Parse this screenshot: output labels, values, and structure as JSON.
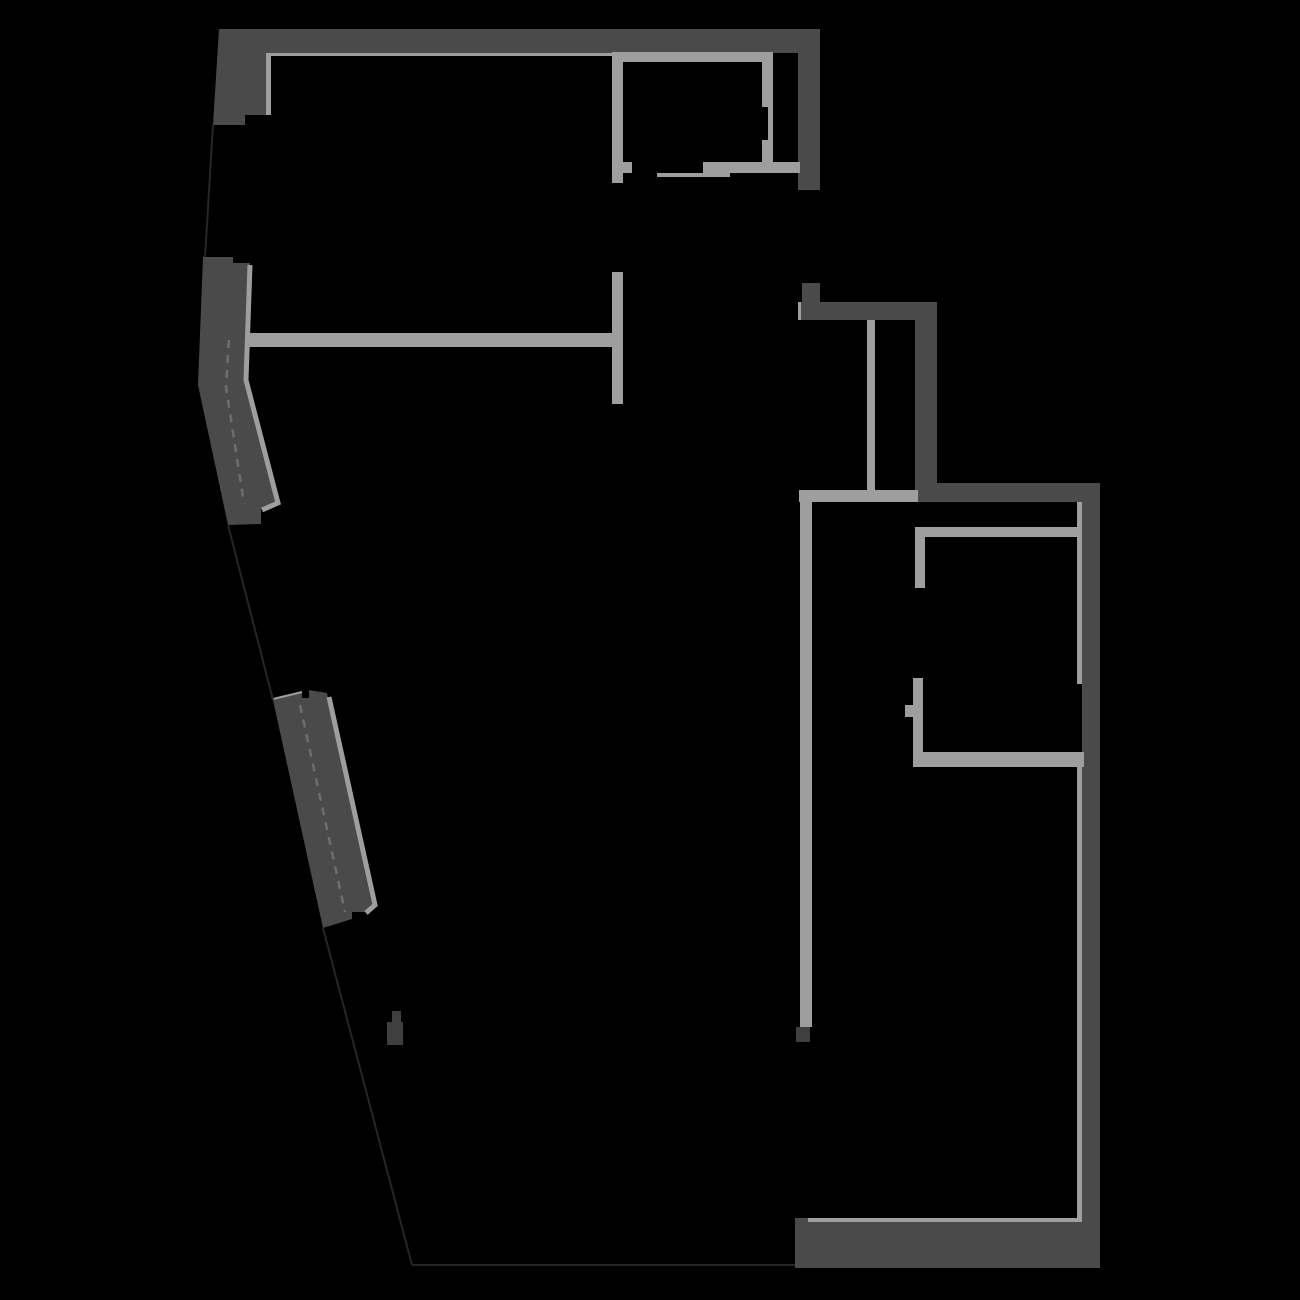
{
  "floorplan": {
    "canvas": {
      "width": 1300,
      "height": 1300,
      "background": "#000000"
    },
    "colors": {
      "bg": "#000000",
      "wall_dark": "#4a4a4a",
      "wall_darker": "#3f3f3f",
      "wall_light": "#9e9e9e",
      "boundary_line": "#262626",
      "glazing_dash": "#6e6e6e"
    },
    "elements": [
      {
        "name": "facade-upper-segment",
        "shape": "polygon",
        "color": "wall_dark",
        "points": "219,29 266,29 266,115 245,115 245,125 213,125"
      },
      {
        "name": "north-outer-wall",
        "shape": "rect",
        "color": "wall_dark",
        "x": 266,
        "y": 29,
        "w": 532,
        "h": 24
      },
      {
        "name": "entry-east-wall",
        "shape": "rect",
        "color": "wall_dark",
        "x": 798,
        "y": 29,
        "w": 22,
        "h": 161
      },
      {
        "name": "facade-middle-segment",
        "shape": "polygon",
        "color": "wall_dark",
        "points": "203,257 233,257 233,263 250,263 246,380 277,505 261,509 261,524 228,525 198,385"
      },
      {
        "name": "facade-lower-segment",
        "shape": "polygon",
        "color": "wall_dark",
        "points": "273,700 302,692 302,698 309,698 309,690 327,693 373,908 365,912 352,912 352,919 323,928"
      },
      {
        "name": "stair-north-wall",
        "shape": "rect",
        "color": "wall_dark",
        "x": 799,
        "y": 302,
        "w": 138,
        "h": 18
      },
      {
        "name": "stair-north-stub",
        "shape": "rect",
        "color": "wall_dark",
        "x": 802,
        "y": 283,
        "w": 18,
        "h": 19
      },
      {
        "name": "stair-east-wall",
        "shape": "rect",
        "color": "wall_dark",
        "x": 915,
        "y": 320,
        "w": 22,
        "h": 163
      },
      {
        "name": "hall-south-wall",
        "shape": "rect",
        "color": "wall_dark",
        "x": 915,
        "y": 483,
        "w": 185,
        "h": 19
      },
      {
        "name": "east-outer-wall",
        "shape": "rect",
        "color": "wall_dark",
        "x": 1082,
        "y": 483,
        "w": 18,
        "h": 785
      },
      {
        "name": "south-outer-wall",
        "shape": "rect",
        "color": "wall_dark",
        "x": 795,
        "y": 1218,
        "w": 305,
        "h": 50
      },
      {
        "name": "kitchen-wall-end-cap",
        "shape": "rect",
        "color": "wall_darker",
        "x": 796,
        "y": 1027,
        "w": 14,
        "h": 15
      },
      {
        "name": "utility-mark",
        "shape": "polygon",
        "color": "wall_darker",
        "points": "392,1011 401,1011 401,1022 403,1022 403,1045 387,1045 387,1022 392,1022"
      },
      {
        "name": "north-wall-inner-face",
        "shape": "rect",
        "color": "wall_light",
        "x": 266,
        "y": 53,
        "w": 346,
        "h": 3
      },
      {
        "name": "corner-inner-face",
        "shape": "rect",
        "color": "wall_light",
        "x": 266,
        "y": 53,
        "w": 5,
        "h": 62
      },
      {
        "name": "closet-top-wall",
        "shape": "rect",
        "color": "wall_light",
        "x": 612,
        "y": 52,
        "w": 161,
        "h": 10
      },
      {
        "name": "closet-left-wall",
        "shape": "rect",
        "color": "wall_light",
        "x": 612,
        "y": 52,
        "w": 11,
        "h": 131
      },
      {
        "name": "closet-left-door-jamb",
        "shape": "rect",
        "color": "wall_light",
        "x": 623,
        "y": 162,
        "w": 9,
        "h": 11
      },
      {
        "name": "closet-right-wall",
        "shape": "rect",
        "color": "wall_light",
        "x": 762,
        "y": 52,
        "w": 11,
        "h": 121
      },
      {
        "name": "closet-right-wall-recess",
        "shape": "rect",
        "color": "bg",
        "x": 762,
        "y": 107,
        "w": 6,
        "h": 33
      },
      {
        "name": "closet-bottom-wall",
        "shape": "rect",
        "color": "wall_light",
        "x": 703,
        "y": 162,
        "w": 97,
        "h": 11
      },
      {
        "name": "closet-door-threshold",
        "shape": "rect",
        "color": "wall_light",
        "x": 657,
        "y": 173,
        "w": 73,
        "h": 4
      },
      {
        "name": "bedroom-divider-wall",
        "shape": "rect",
        "color": "wall_light",
        "x": 247,
        "y": 333,
        "w": 365,
        "h": 14
      },
      {
        "name": "bedroom-divider-return",
        "shape": "rect",
        "color": "wall_light",
        "x": 612,
        "y": 272,
        "w": 11,
        "h": 132
      },
      {
        "name": "facade-middle-inner-edge",
        "shape": "polyline",
        "color": "wall_light",
        "points": "250,265 246,380 278,503 262,510",
        "width": 5
      },
      {
        "name": "facade-lower-inner-edge",
        "shape": "polyline",
        "color": "wall_light",
        "points": "329,697 375,905 366,913",
        "width": 5
      },
      {
        "name": "facade-lower-top-edge",
        "shape": "polyline",
        "color": "wall_light",
        "points": "273,699 302,692",
        "width": 2
      },
      {
        "name": "hall-divider-wall",
        "shape": "rect",
        "color": "wall_light",
        "x": 799,
        "y": 490,
        "w": 119,
        "h": 12
      },
      {
        "name": "stair-rail-wall",
        "shape": "rect",
        "color": "wall_light",
        "x": 867,
        "y": 320,
        "w": 8,
        "h": 170
      },
      {
        "name": "kitchen-wall",
        "shape": "rect",
        "color": "wall_light",
        "x": 800,
        "y": 492,
        "w": 12,
        "h": 535
      },
      {
        "name": "bathroom-top-wall",
        "shape": "rect",
        "color": "wall_light",
        "x": 915,
        "y": 527,
        "w": 167,
        "h": 10
      },
      {
        "name": "bathroom-left-wall-upper",
        "shape": "rect",
        "color": "wall_light",
        "x": 915,
        "y": 527,
        "w": 10,
        "h": 61
      },
      {
        "name": "bathroom-left-wall-lower",
        "shape": "rect",
        "color": "wall_light",
        "x": 913,
        "y": 678,
        "w": 10,
        "h": 89
      },
      {
        "name": "bathroom-door-jamb",
        "shape": "rect",
        "color": "wall_light",
        "x": 905,
        "y": 705,
        "w": 8,
        "h": 12
      },
      {
        "name": "bathroom-bottom-wall",
        "shape": "rect",
        "color": "wall_light",
        "x": 913,
        "y": 752,
        "w": 171,
        "h": 15
      },
      {
        "name": "east-wall-inner-face-upper",
        "shape": "rect",
        "color": "wall_light",
        "x": 1077,
        "y": 502,
        "w": 5,
        "h": 182
      },
      {
        "name": "east-wall-inner-face-lower",
        "shape": "rect",
        "color": "wall_light",
        "x": 1077,
        "y": 767,
        "w": 5,
        "h": 451
      },
      {
        "name": "south-wall-inner-face",
        "shape": "rect",
        "color": "wall_light",
        "x": 808,
        "y": 1218,
        "w": 274,
        "h": 4
      },
      {
        "name": "stair-wall-tick",
        "shape": "rect",
        "color": "wall_light",
        "x": 798,
        "y": 302,
        "w": 3,
        "h": 18
      },
      {
        "name": "boundary-left-upper",
        "shape": "polyline",
        "color": "boundary_line",
        "points": "213,125 205,257",
        "width": 2
      },
      {
        "name": "boundary-left-middle",
        "shape": "polyline",
        "color": "boundary_line",
        "points": "228,525 273,700",
        "width": 2
      },
      {
        "name": "boundary-left-lower",
        "shape": "polyline",
        "color": "boundary_line",
        "points": "323,928 412,1265",
        "width": 2
      },
      {
        "name": "boundary-bottom",
        "shape": "polyline",
        "color": "boundary_line",
        "points": "412,1265 795,1265",
        "width": 2
      },
      {
        "name": "window-glazing-middle",
        "shape": "polyline",
        "color": "glazing_dash",
        "points": "229,340 226,387 244,504",
        "width": 2.5,
        "dash": "8 7"
      },
      {
        "name": "window-glazing-lower",
        "shape": "polyline",
        "color": "glazing_dash",
        "points": "300,705 345,912",
        "width": 2.5,
        "dash": "8 7"
      }
    ]
  }
}
